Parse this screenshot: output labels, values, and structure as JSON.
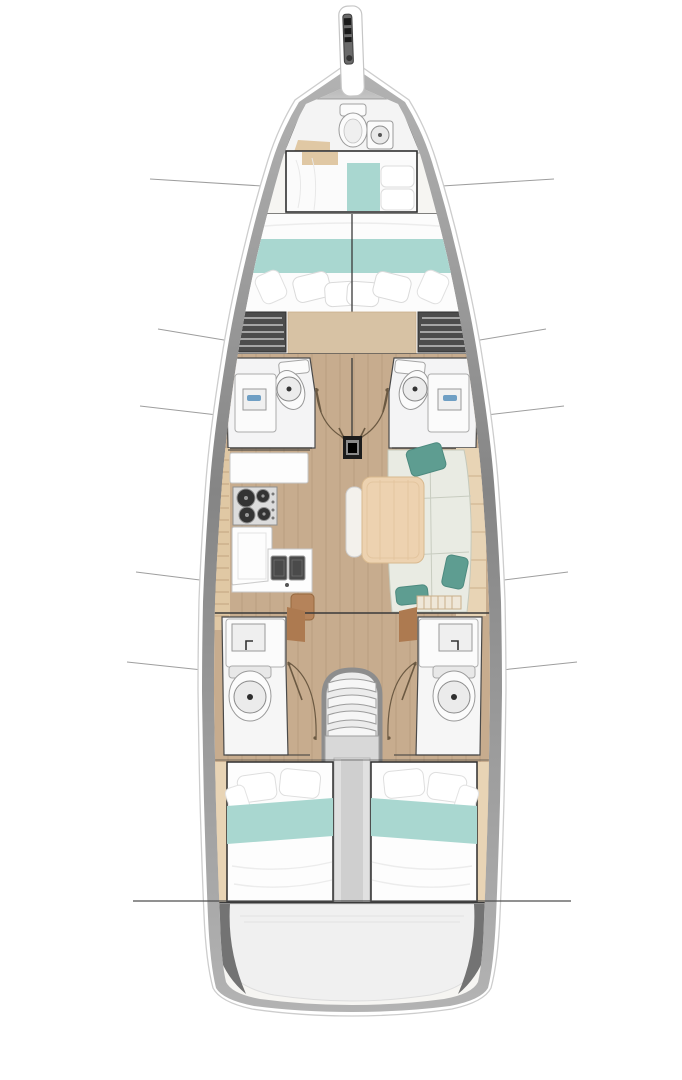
{
  "meta": {
    "title": "sailing-yacht-interior-floor-plan",
    "view": "top-down",
    "orientation": "bow-up",
    "text_visible": "none"
  },
  "palette": {
    "interior-base": "#f6f5f2",
    "hull-band-dark": "#858585",
    "hull-band-light": "#b3b3b3",
    "bow-wedge": "#9a9a9a",
    "wood": "#c7ac8e",
    "wood-light": "#d7c2a4",
    "tan": "#e0c8a4",
    "tan-light": "#e8d4b5",
    "teal": "#a9d7d0",
    "teal-dark": "#5e9d91",
    "white-fixture": "#fbfbfb",
    "line-dark": "#3a3a3a",
    "line-faint": "#9e9e9e",
    "locker-dark": "#4c4c4c",
    "locker-slat": "#a5a5a5",
    "sink-basin": "#4a4a4a",
    "burner": "#333333",
    "table-wood": "#edd2b0",
    "sofa": "#e9ebe3",
    "platform": "#f0f0f0",
    "platform-wedge": "#737373",
    "stair-landing": "#d8d8d8",
    "mast": "#1c1c1c",
    "door-arc": "#6b5942",
    "blue-accent": "#6f9fc4",
    "brown-door": "#ad7a50",
    "seat-brown": "#b5835a"
  },
  "rooms": [
    {
      "id": "bowsprit",
      "fixtures": [
        "anchor-roller"
      ]
    },
    {
      "id": "bow-deck",
      "fixtures": [
        "chain-locker-wedge"
      ]
    },
    {
      "id": "forward-head",
      "fixtures": [
        "toilet",
        "shower",
        "seat"
      ]
    },
    {
      "id": "forward-owner-berth",
      "fixtures": [
        "berth",
        "teal-runner",
        "pillows",
        "headboard"
      ]
    },
    {
      "id": "forward-v-berth",
      "fixtures": [
        "double-berth",
        "teal-band",
        "4-pillows",
        "wood-step",
        "slatted-lockers-port",
        "slatted-lockers-starboard"
      ]
    },
    {
      "id": "midship-head-port",
      "fixtures": [
        "toilet",
        "sink-vanity",
        "door-swing"
      ]
    },
    {
      "id": "midship-head-starboard",
      "fixtures": [
        "toilet",
        "sink-vanity",
        "door-swing"
      ]
    },
    {
      "id": "mast-step",
      "fixtures": [
        "mast-base"
      ]
    },
    {
      "id": "galley-port",
      "fixtures": [
        "counter",
        "stove-3-burner",
        "refrigerator",
        "double-sink",
        "side-shelf",
        "nav-seat"
      ]
    },
    {
      "id": "salon-starboard",
      "fixtures": [
        "u-sofa",
        "teal-throw-pillows",
        "dining-table",
        "bench-seat",
        "seatback-cushions",
        "slatted-step"
      ]
    },
    {
      "id": "aft-head-port",
      "fixtures": [
        "sink-vanity",
        "toilet",
        "door-swing",
        "wood-door-panel"
      ]
    },
    {
      "id": "aft-head-starboard",
      "fixtures": [
        "sink-vanity",
        "toilet",
        "door-swing",
        "wood-door-panel"
      ]
    },
    {
      "id": "companionway",
      "fixtures": [
        "4-curved-steps",
        "handrails",
        "landing"
      ]
    },
    {
      "id": "engine-compartment",
      "fixtures": [
        "center-trunk"
      ]
    },
    {
      "id": "aft-cabin-port",
      "fixtures": [
        "double-berth",
        "teal-band",
        "pillows"
      ]
    },
    {
      "id": "aft-cabin-starboard",
      "fixtures": [
        "double-berth",
        "teal-band",
        "pillows"
      ]
    },
    {
      "id": "stern-platform",
      "fixtures": [
        "transom-wedges"
      ]
    }
  ],
  "hull_section_lines": {
    "count_pairs": 5,
    "full_width_line_y": 901
  }
}
